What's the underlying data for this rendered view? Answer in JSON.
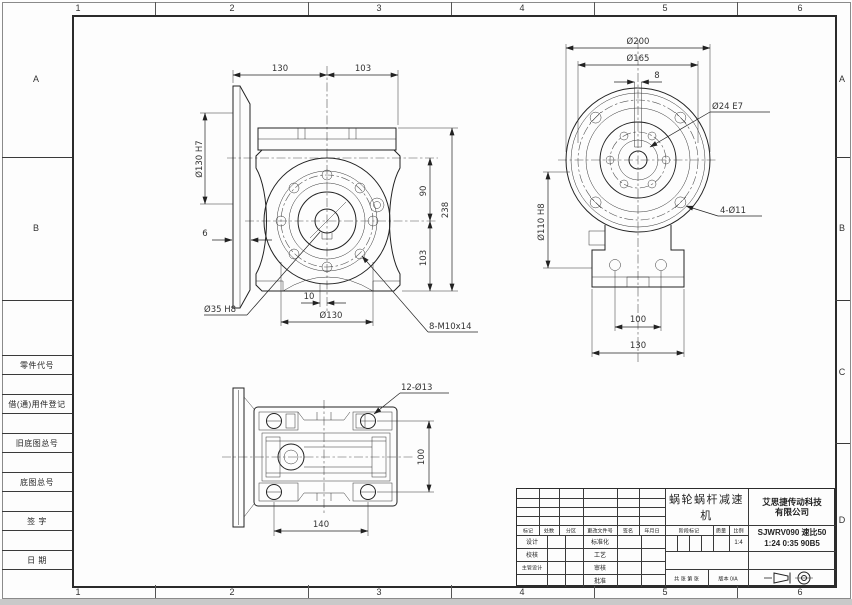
{
  "frame": {
    "zones_top": [
      "1",
      "2",
      "3",
      "4",
      "5",
      "6"
    ],
    "zones_bottom": [
      "1",
      "2",
      "3",
      "4",
      "5",
      "6"
    ],
    "zones_left": [
      "A",
      "B"
    ],
    "zones_right": [
      "A",
      "B",
      "C",
      "D"
    ]
  },
  "stub_column": {
    "rows": [
      "零件代号",
      "借(通)用件登记",
      "旧底图总号",
      "底图总号",
      "签  字",
      "日  期"
    ]
  },
  "drawing": {
    "front": {
      "width_left": "130",
      "width_right": "103",
      "flange_spigot": "Ø130 H7",
      "flange_thickness": "6",
      "center_height": "90",
      "lower_height": "103",
      "total_height": "238",
      "keyway_offset": "10",
      "bolt_circle": "Ø130",
      "tapped_holes": "8-M10x14",
      "output_bore": "Ø35 H8"
    },
    "side": {
      "outer_dia": "Ø200",
      "bolt_circle_dia": "Ø165",
      "keyway_width": "8",
      "input_bore": "Ø24 E7",
      "pilot_dia": "Ø110 H8",
      "flange_holes": "4-Ø11",
      "foot_hole_span": "100",
      "foot_width": "130"
    },
    "bottom": {
      "foot_holes": "12-Ø13",
      "hole_span_depth": "100",
      "hole_span_width": "140"
    }
  },
  "title_block": {
    "product": "蜗轮蜗杆减速机",
    "company_line1": "艾思捷传动科技",
    "company_line2": "有限公司",
    "model_line1": "SJWRV090 速比50",
    "model_line2": "1:24 0:35 90B5",
    "scale_value": "1:4",
    "labels": {
      "mark": "标记",
      "count": "处数",
      "zone": "分区",
      "change_file_no": "更改文件号",
      "signature": "签名",
      "date": "年月日",
      "design": "设计",
      "standardize": "标准化",
      "check": "校核",
      "process": "工艺",
      "chief_design": "主管设计",
      "review": "审核",
      "approve": "批准",
      "stage_mark": "阶段标记",
      "weight": "质量",
      "scale": "比例",
      "sheets": "共 张 第 张",
      "version": "版本 0/A"
    }
  }
}
